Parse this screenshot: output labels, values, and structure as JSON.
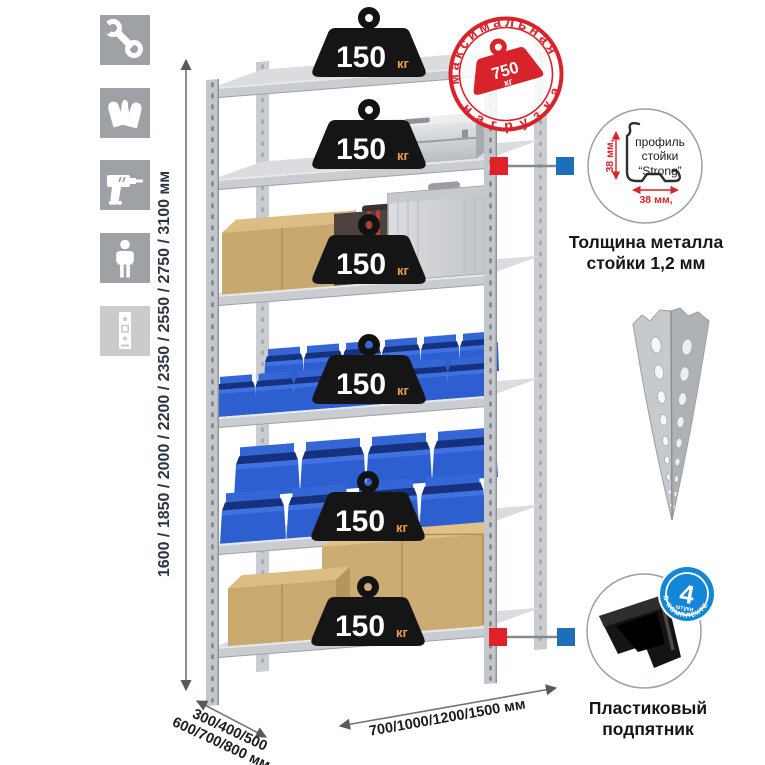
{
  "sidebar": {
    "tiles": [
      {
        "icon": "wrench-icon"
      },
      {
        "icon": "gloves-icon"
      },
      {
        "icon": "drill-icon"
      },
      {
        "icon": "person-icon"
      },
      {
        "icon": "rack-post-icon"
      }
    ]
  },
  "rack": {
    "shelf_count": 6,
    "weight_label": {
      "value": "150",
      "unit": "кг"
    }
  },
  "stamp": {
    "arc_top": "максимальная",
    "arc_bottom": "нагрузка",
    "value": "750",
    "unit": "кг"
  },
  "dims": {
    "height": "1600 / 1850 / 2000 / 2200 / 2350 / 2550 / 2750 / 3100 мм",
    "depth_line1": "300/400/500",
    "depth_line2": "600/700/800 мм",
    "width": "700/1000/1200/1500 мм"
  },
  "profile": {
    "line1": "профиль",
    "line2": "стойки",
    "line3": "“Strong”",
    "dim_v": "38 мм,",
    "dim_h": "38 мм,",
    "caption1": "Толщина металла",
    "caption2": "стойки 1,2 мм"
  },
  "foot": {
    "badge_value": "4",
    "badge_word": "штуки",
    "badge_arc": "в комплекте",
    "caption1": "Пластиковый",
    "caption2": "подпятник"
  },
  "colors": {
    "red": "#d8232a",
    "marker_blue": "#1c6fb8",
    "bin_blue": "#2e5fd0",
    "tile_gray": "#9ea1a5"
  }
}
